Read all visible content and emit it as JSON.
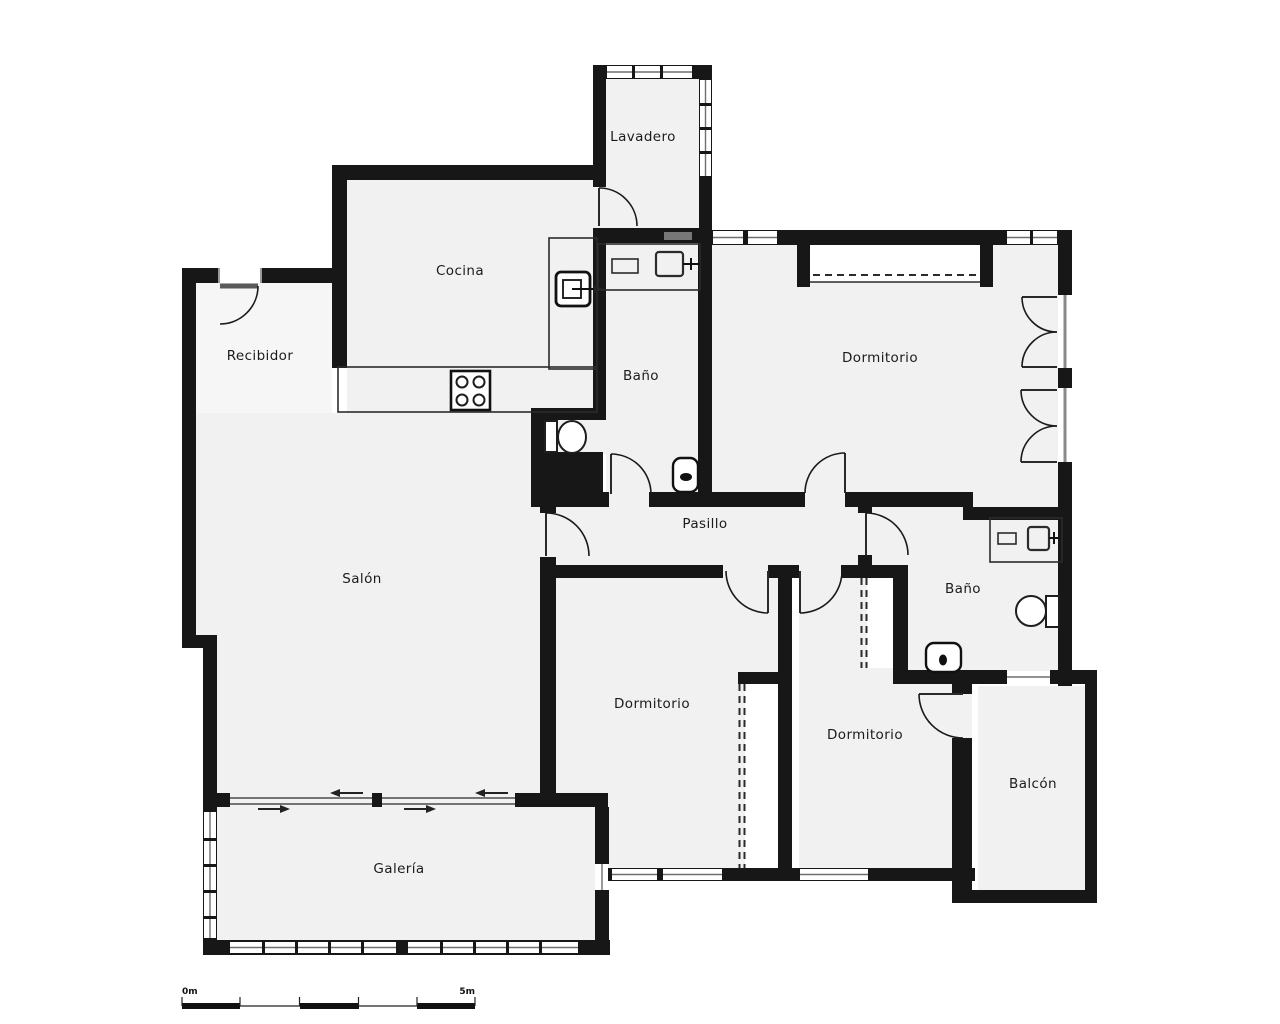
{
  "plan": {
    "rooms": [
      {
        "id": "lavadero",
        "label": "Lavadero"
      },
      {
        "id": "cocina",
        "label": "Cocina"
      },
      {
        "id": "recibidor",
        "label": "Recibidor"
      },
      {
        "id": "bano-1",
        "label": "Baño"
      },
      {
        "id": "dormitorio-principal",
        "label": "Dormitorio"
      },
      {
        "id": "pasillo",
        "label": "Pasillo"
      },
      {
        "id": "salon",
        "label": "Salón"
      },
      {
        "id": "dormitorio-2",
        "label": "Dormitorio"
      },
      {
        "id": "bano-2",
        "label": "Baño"
      },
      {
        "id": "dormitorio-3",
        "label": "Dormitorio"
      },
      {
        "id": "balcon",
        "label": "Balcón"
      },
      {
        "id": "galeria",
        "label": "Galería"
      }
    ],
    "scale_bar": {
      "start_label": "0m",
      "end_label": "5m"
    },
    "colors": {
      "wall": "#171717",
      "floor": "#f1f1f1",
      "recibidor_floor": "#f6f6f6",
      "background": "#ffffff",
      "label": "#1b1b1b"
    },
    "icons": [
      "stove-icon",
      "oven-icon",
      "kitchen-sink-icon",
      "bathroom-sink-icon",
      "toilet-icon",
      "bidet-icon",
      "wardrobe-icon",
      "door-swing-icon",
      "sliding-door-arrow-icon",
      "window-icon"
    ]
  }
}
